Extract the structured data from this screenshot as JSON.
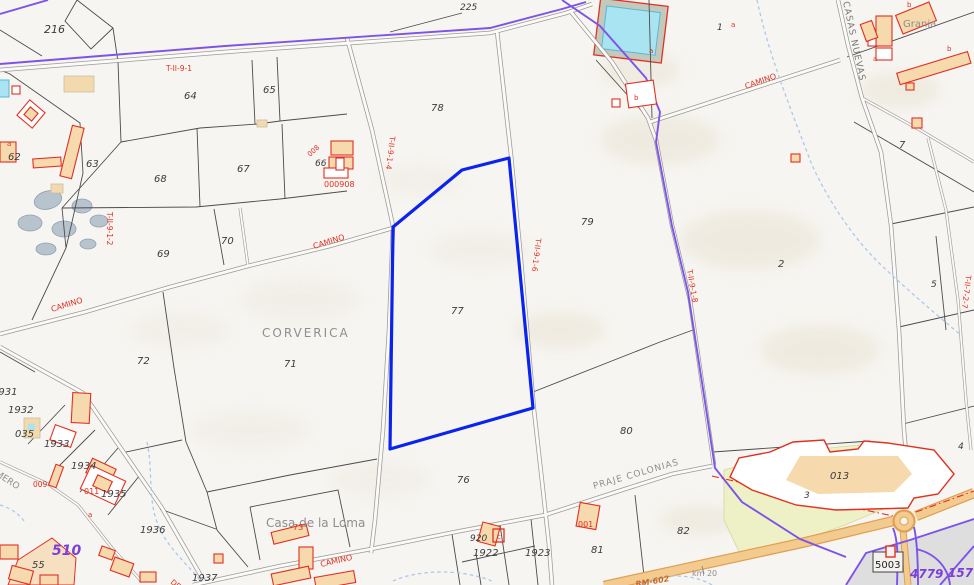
{
  "map": {
    "type": "cadastral-parcel-map",
    "region_label": "CORVERICA",
    "colors": {
      "selected_outline": "#0a23ee",
      "boundary_purple": "#7d53e8",
      "purple_text": "#7d3fd8",
      "cadastral_red": "#e13022",
      "water_cyan": "#a9e4f2",
      "highway_orange": "#f4cb8e",
      "yellow_zone": "#eef1c6",
      "background": "#f7f5f1"
    },
    "selected_parcel": {
      "number": "77",
      "points": "393,227 462,170 509,158 533,408 390,449"
    },
    "labels": {
      "parcel_numbers": [
        {
          "text": "216",
          "x": 44,
          "y": 33,
          "size": 11
        },
        {
          "text": "225",
          "x": 460,
          "y": 10,
          "size": 9
        },
        {
          "text": "64",
          "x": 184,
          "y": 99,
          "size": 10
        },
        {
          "text": "65",
          "x": 263,
          "y": 93,
          "size": 10
        },
        {
          "text": "66",
          "x": 315,
          "y": 166,
          "size": 9
        },
        {
          "text": "67",
          "x": 237,
          "y": 172,
          "size": 10
        },
        {
          "text": "68",
          "x": 154,
          "y": 182,
          "size": 10
        },
        {
          "text": "62",
          "x": 8,
          "y": 160,
          "size": 10
        },
        {
          "text": "63",
          "x": 86,
          "y": 167,
          "size": 10
        },
        {
          "text": "69",
          "x": 157,
          "y": 257,
          "size": 10
        },
        {
          "text": "70",
          "x": 221,
          "y": 244,
          "size": 10
        },
        {
          "text": "71",
          "x": 284,
          "y": 367,
          "size": 10
        },
        {
          "text": "72",
          "x": 137,
          "y": 364,
          "size": 10
        },
        {
          "text": "76",
          "x": 457,
          "y": 483,
          "size": 10
        },
        {
          "text": "77",
          "x": 451,
          "y": 314,
          "size": 10
        },
        {
          "text": "78",
          "x": 431,
          "y": 111,
          "size": 10
        },
        {
          "text": "79",
          "x": 581,
          "y": 225,
          "size": 10
        },
        {
          "text": "80",
          "x": 620,
          "y": 434,
          "size": 10
        },
        {
          "text": "81",
          "x": 591,
          "y": 553,
          "size": 10
        },
        {
          "text": "82",
          "x": 677,
          "y": 534,
          "size": 10
        },
        {
          "text": "1",
          "x": 717,
          "y": 30,
          "size": 9
        },
        {
          "text": "2",
          "x": 778,
          "y": 267,
          "size": 10
        },
        {
          "text": "3",
          "x": 804,
          "y": 498,
          "size": 9
        },
        {
          "text": "4",
          "x": 958,
          "y": 449,
          "size": 9
        },
        {
          "text": "5",
          "x": 931,
          "y": 287,
          "size": 9
        },
        {
          "text": "7",
          "x": 899,
          "y": 148,
          "size": 10
        },
        {
          "text": "55",
          "x": 32,
          "y": 568,
          "size": 10
        },
        {
          "text": "1922",
          "x": 473,
          "y": 556,
          "size": 10
        },
        {
          "text": "1923",
          "x": 525,
          "y": 556,
          "size": 10
        },
        {
          "text": "1931",
          "x": -8,
          "y": 395,
          "size": 10
        },
        {
          "text": "1932",
          "x": 8,
          "y": 413,
          "size": 10
        },
        {
          "text": "1933",
          "x": 44,
          "y": 447,
          "size": 10
        },
        {
          "text": "1934",
          "x": 71,
          "y": 469,
          "size": 10
        },
        {
          "text": "1935",
          "x": 101,
          "y": 497,
          "size": 10
        },
        {
          "text": "1936",
          "x": 140,
          "y": 533,
          "size": 10
        },
        {
          "text": "1937",
          "x": 192,
          "y": 581,
          "size": 10
        },
        {
          "text": "035",
          "x": 15,
          "y": 437,
          "size": 10
        },
        {
          "text": "920",
          "x": 470,
          "y": 541,
          "size": 9
        },
        {
          "text": "013",
          "x": 830,
          "y": 479,
          "size": 10
        },
        {
          "text": "5003",
          "x": 875,
          "y": 568,
          "size": 10,
          "cls": "plain"
        }
      ],
      "place_names": [
        {
          "text": "CORVERICA",
          "x": 262,
          "y": 337,
          "size": 12,
          "ls": 2
        },
        {
          "text": "Casa de la Loma",
          "x": 266,
          "y": 527,
          "size": 12
        },
        {
          "text": "Granja",
          "x": 903,
          "y": 27,
          "size": 10
        },
        {
          "text": "PRAJE COLONIAS",
          "x": 594,
          "y": 489,
          "size": 9,
          "rot": -16,
          "ls": 1
        },
        {
          "text": "CASAS NUEVAS",
          "x": 843,
          "y": 2,
          "size": 9,
          "rot": 78,
          "ls": 1,
          "cls": "dgray"
        },
        {
          "text": "km 20",
          "x": 692,
          "y": 576,
          "size": 8
        },
        {
          "text": "RUMERO",
          "x": -16,
          "y": 468,
          "size": 9,
          "rot": 33
        }
      ],
      "cadastral_codes": [
        {
          "text": "T-II-9-1",
          "x": 166,
          "y": 71,
          "size": 7.5
        },
        {
          "text": "T-II-9-1-2",
          "x": 107,
          "y": 212,
          "size": 7.5,
          "rot": 90
        },
        {
          "text": "T-II-9-1-4",
          "x": 390,
          "y": 136,
          "size": 7.5,
          "rot": 97
        },
        {
          "text": "T-II-9-1-6",
          "x": 536,
          "y": 238,
          "size": 7.5,
          "rot": 97
        },
        {
          "text": "T-II-9-1-8",
          "x": 687,
          "y": 270,
          "size": 7.5,
          "rot": 80
        },
        {
          "text": "T-II-7-2-7",
          "x": 966,
          "y": 275,
          "size": 7.5,
          "rot": 97
        },
        {
          "text": "000908",
          "x": 324,
          "y": 187,
          "size": 8
        },
        {
          "text": "008",
          "x": 310,
          "y": 157,
          "size": 7,
          "rot": -42
        },
        {
          "text": "009",
          "x": 33,
          "y": 487,
          "size": 7.5
        },
        {
          "text": "011",
          "x": 84,
          "y": 494,
          "size": 8
        },
        {
          "text": "001",
          "x": 578,
          "y": 527,
          "size": 8
        },
        {
          "text": "73",
          "x": 293,
          "y": 530,
          "size": 8
        }
      ],
      "road_labels": [
        {
          "text": "CAMINO",
          "x": 52,
          "y": 312,
          "size": 8,
          "rot": -17
        },
        {
          "text": "CAMINO",
          "x": 314,
          "y": 249,
          "size": 8,
          "rot": -17
        },
        {
          "text": "CAMINO",
          "x": 746,
          "y": 89,
          "size": 8,
          "rot": -19
        },
        {
          "text": "CAMINO",
          "x": 321,
          "y": 567,
          "size": 8,
          "rot": -13
        },
        {
          "text": "DEL",
          "x": 170,
          "y": 583,
          "size": 7.5,
          "rot": 38
        }
      ],
      "road_numbers": [
        {
          "text": "510",
          "x": 52,
          "y": 555,
          "size": 14
        },
        {
          "text": "4779",
          "x": 910,
          "y": 578,
          "size": 12
        },
        {
          "text": "1577",
          "x": 948,
          "y": 577,
          "size": 12
        },
        {
          "text": "RM-602",
          "x": 636,
          "y": 587,
          "size": 8,
          "rot": -10,
          "cls": "orange"
        }
      ],
      "building_letters": [
        {
          "text": "a",
          "x": 731,
          "y": 27,
          "size": 7
        },
        {
          "text": "a",
          "x": 873,
          "y": 61,
          "size": 7
        },
        {
          "text": "b",
          "x": 947,
          "y": 51,
          "size": 7
        },
        {
          "text": "b",
          "x": 907,
          "y": 7,
          "size": 7
        },
        {
          "text": "b",
          "x": 634,
          "y": 100,
          "size": 7
        },
        {
          "text": "a",
          "x": 649,
          "y": 53,
          "size": 7
        },
        {
          "text": "a",
          "x": 88,
          "y": 517,
          "size": 7
        },
        {
          "text": "a",
          "x": 7,
          "y": 146,
          "size": 7
        },
        {
          "text": "c",
          "x": 497,
          "y": 539,
          "size": 7
        }
      ]
    }
  }
}
